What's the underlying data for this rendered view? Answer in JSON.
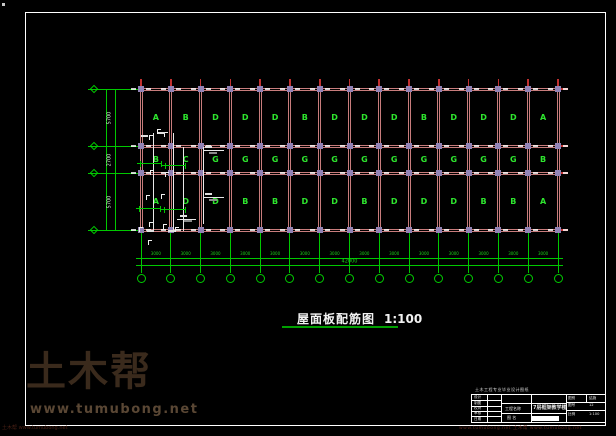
{
  "watermark": {
    "logo": "土木帮",
    "url": "www.tumubong.net",
    "footer_left": "土木帮 www.tumubong.net",
    "footer_right": "www.tumubong.net 土木帮 www.tumubong.net"
  },
  "drawing_title": {
    "text": "屋面板配筋图",
    "scale": "1:100"
  },
  "plan": {
    "slab_rows": [
      [
        "A",
        "B",
        "D",
        "D",
        "D",
        "B",
        "D",
        "D",
        "D",
        "B",
        "D",
        "D",
        "D",
        "A"
      ],
      [
        "B",
        "C",
        "G",
        "G",
        "G",
        "G",
        "G",
        "G",
        "G",
        "G",
        "G",
        "G",
        "G",
        "B"
      ],
      [
        "A",
        "D",
        "D",
        "B",
        "B",
        "D",
        "D",
        "B",
        "D",
        "D",
        "D",
        "B",
        "B",
        "A"
      ]
    ],
    "axis_count": 15,
    "dims": {
      "left": [
        "5700",
        "2700",
        "5700"
      ],
      "bay": "3000",
      "total": "42000"
    }
  },
  "title_block": {
    "header": "土木工程专业毕业设计图纸",
    "left_rows": [
      "设计",
      "制图",
      "校对",
      "审核",
      "日期"
    ],
    "project_label": "工程名称",
    "project_name": "7层框架教学楼",
    "name_label": "图 名",
    "right_cells": [
      [
        "图别",
        "结施"
      ],
      [
        "图号",
        "12"
      ],
      [
        "比例",
        "1:100"
      ]
    ]
  },
  "colors": {
    "grid_line": "#c87c7c",
    "grid_node": "#9183b5",
    "green": "#00c800",
    "letter_green": "#2ee52e",
    "red_tick": "#c03030",
    "white": "#ffffff"
  }
}
